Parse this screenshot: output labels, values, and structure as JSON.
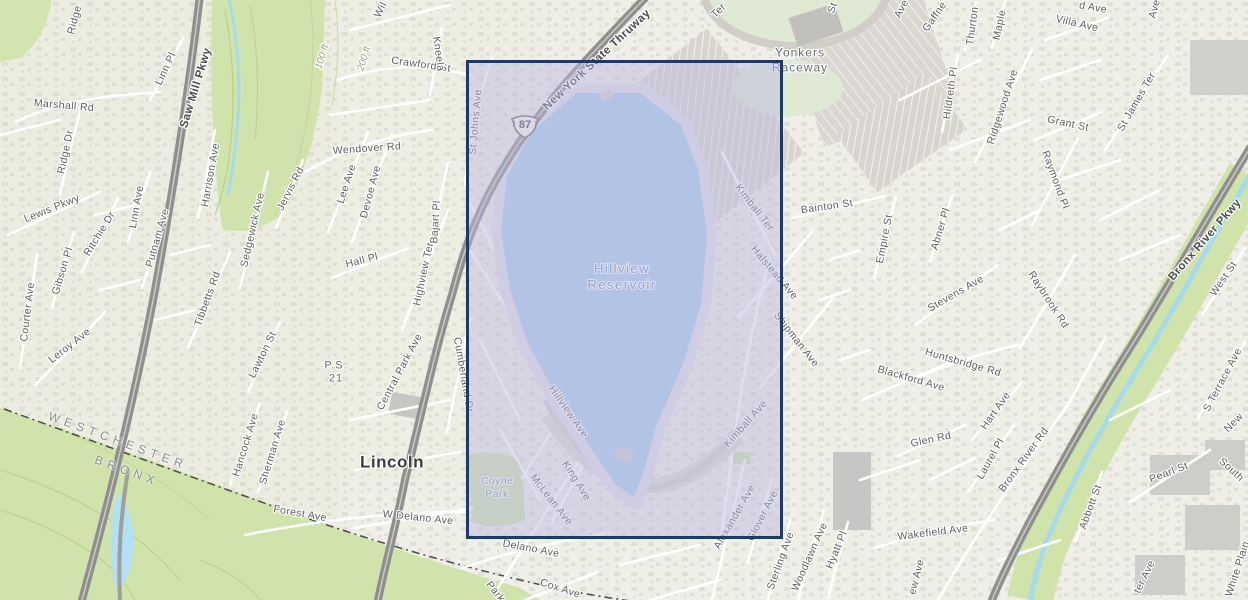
{
  "map": {
    "place_labels": {
      "reservoir": "Hillview\nReservoir",
      "raceway": "Yonkers\nRaceway",
      "city": "Lincoln",
      "park": "Coyne\nPark",
      "school": "P.S.\n21",
      "county_north": "WESTCHESTER",
      "county_south": "BRONX"
    },
    "shield": {
      "route": "87",
      "x": 525,
      "y": 126
    },
    "selection": {
      "x": 466,
      "y": 60,
      "width": 317,
      "height": 479
    },
    "colors": {
      "selection_border": "#1d3a66",
      "selection_fill": "rgba(188,185,226,0.48)",
      "water": "#a9cbe9",
      "park_green": "#cfe3ab",
      "major_road": "#949494",
      "land": "#efeee7"
    },
    "labels": [
      {
        "t": "Marshall Rd",
        "x": 64,
        "y": 106,
        "r": 5
      },
      {
        "t": "Linn Pl",
        "x": 166,
        "y": 69,
        "r": -65
      },
      {
        "t": "Ridge",
        "x": 75,
        "y": 20,
        "r": -75
      },
      {
        "t": "Ridge Dr",
        "x": 66,
        "y": 152,
        "r": -78
      },
      {
        "t": "Lewis Pkwy",
        "x": 52,
        "y": 209,
        "r": -22
      },
      {
        "t": "Gibson Pl",
        "x": 63,
        "y": 271,
        "r": -73
      },
      {
        "t": "Ritchie Dr",
        "x": 100,
        "y": 234,
        "r": -58
      },
      {
        "t": "Courter Ave",
        "x": 28,
        "y": 312,
        "r": -83
      },
      {
        "t": "Leroy Ave",
        "x": 70,
        "y": 346,
        "r": -38
      },
      {
        "t": "Linn Ave",
        "x": 137,
        "y": 207,
        "r": -80
      },
      {
        "t": "Putnam Ave",
        "x": 158,
        "y": 238,
        "r": -74
      },
      {
        "t": "Saw Mill Pkwy",
        "x": 196,
        "y": 88,
        "r": -73,
        "c": "major"
      },
      {
        "t": "Harrison Ave",
        "x": 211,
        "y": 175,
        "r": -80
      },
      {
        "t": "Sedgewick Ave",
        "x": 253,
        "y": 230,
        "r": -77
      },
      {
        "t": "Jervis Rd",
        "x": 291,
        "y": 189,
        "r": -63
      },
      {
        "t": "Tibbetts Rd",
        "x": 208,
        "y": 299,
        "r": -70
      },
      {
        "t": "Lawton St",
        "x": 263,
        "y": 355,
        "r": -64
      },
      {
        "t": "Hancock Ave",
        "x": 246,
        "y": 445,
        "r": -73
      },
      {
        "t": "Sherman Ave",
        "x": 273,
        "y": 452,
        "r": -73
      },
      {
        "t": "Forest Ave",
        "x": 300,
        "y": 514,
        "r": 10
      },
      {
        "t": "WESTCHESTER",
        "x": 118,
        "y": 441,
        "r": 20,
        "c": "boundary"
      },
      {
        "t": "BRONX",
        "x": 127,
        "y": 471,
        "r": 20,
        "c": "boundary"
      },
      {
        "t": "100 ft",
        "x": 323,
        "y": 57,
        "r": -73,
        "c": "contour"
      },
      {
        "t": "200 ft",
        "x": 365,
        "y": 59,
        "r": -73,
        "c": "contour"
      },
      {
        "t": "P.S.\n21",
        "x": 336,
        "y": 373,
        "r": 0,
        "c": "place",
        "fs": 11
      },
      {
        "t": "Lincoln",
        "x": 392,
        "y": 463,
        "r": 0,
        "c": "city"
      },
      {
        "t": "Central Park Ave",
        "x": 400,
        "y": 372,
        "r": -62
      },
      {
        "t": "Cumberland Dr",
        "x": 463,
        "y": 375,
        "r": 80
      },
      {
        "t": "W Delano Ave",
        "x": 418,
        "y": 518,
        "r": 6
      },
      {
        "t": "Delano Ave",
        "x": 531,
        "y": 549,
        "r": 11
      },
      {
        "t": "Cox Ave",
        "x": 560,
        "y": 589,
        "r": 18
      },
      {
        "t": "Park",
        "x": 495,
        "y": 592,
        "r": 52
      },
      {
        "t": "Coyne\nPark",
        "x": 497,
        "y": 488,
        "r": 0,
        "c": "park"
      },
      {
        "t": "McLean Ave",
        "x": 551,
        "y": 500,
        "r": 52
      },
      {
        "t": "King Ave",
        "x": 576,
        "y": 481,
        "r": 58
      },
      {
        "t": "Hillview Ave",
        "x": 568,
        "y": 412,
        "r": 55
      },
      {
        "t": "Hillview\nReservoir",
        "x": 622,
        "y": 277,
        "r": 0,
        "c": "water"
      },
      {
        "t": "St Johns Ave",
        "x": 476,
        "y": 122,
        "r": -85
      },
      {
        "t": "New York State Thruway",
        "x": 597,
        "y": 60,
        "r": -43,
        "c": "major"
      },
      {
        "t": "Crawford St",
        "x": 421,
        "y": 65,
        "r": 8
      },
      {
        "t": "Wendover Rd",
        "x": 367,
        "y": 149,
        "r": -4
      },
      {
        "t": "Lee Ave",
        "x": 347,
        "y": 184,
        "r": -72
      },
      {
        "t": "Devoe Ave",
        "x": 371,
        "y": 192,
        "r": -75
      },
      {
        "t": "Hall Pl",
        "x": 362,
        "y": 261,
        "r": -14
      },
      {
        "t": "Bajart Pl",
        "x": 436,
        "y": 222,
        "r": -86
      },
      {
        "t": "Highview Ter",
        "x": 424,
        "y": 274,
        "r": -78
      },
      {
        "t": "Kneela",
        "x": 438,
        "y": 54,
        "r": 82
      },
      {
        "t": "Wil",
        "x": 381,
        "y": 10,
        "r": -62
      },
      {
        "t": "Ter",
        "x": 719,
        "y": 11,
        "r": -45
      },
      {
        "t": "St",
        "x": 833,
        "y": 8,
        "r": -70
      },
      {
        "t": "Yonkers\nRaceway",
        "x": 800,
        "y": 60,
        "r": 0,
        "c": "place"
      },
      {
        "t": "Kimball Ter",
        "x": 754,
        "y": 208,
        "r": 52
      },
      {
        "t": "Halstead Ave",
        "x": 774,
        "y": 273,
        "r": 50
      },
      {
        "t": "Shipman Ave",
        "x": 796,
        "y": 340,
        "r": 52
      },
      {
        "t": "Kimball Ave",
        "x": 746,
        "y": 424,
        "r": -48
      },
      {
        "t": "Bainton St",
        "x": 827,
        "y": 207,
        "r": -8
      },
      {
        "t": "Gaffne",
        "x": 935,
        "y": 17,
        "r": -55
      },
      {
        "t": "Ave",
        "x": 902,
        "y": 9,
        "r": -62
      },
      {
        "t": "Thurton",
        "x": 973,
        "y": 26,
        "r": -82
      },
      {
        "t": "Maple",
        "x": 1000,
        "y": 25,
        "r": -78
      },
      {
        "t": "Hildreth Pl",
        "x": 951,
        "y": 93,
        "r": -82
      },
      {
        "t": "Ridgewood Ave",
        "x": 1003,
        "y": 107,
        "r": -72
      },
      {
        "t": "d Ave",
        "x": 1093,
        "y": 8,
        "r": 10
      },
      {
        "t": "Villa Ave",
        "x": 1077,
        "y": 24,
        "r": 13
      },
      {
        "t": "Grant St",
        "x": 1068,
        "y": 124,
        "r": 12
      },
      {
        "t": "Raymond Pl",
        "x": 1055,
        "y": 180,
        "r": 70
      },
      {
        "t": "St James Ter",
        "x": 1137,
        "y": 102,
        "r": -60
      },
      {
        "t": "Ave",
        "x": 1155,
        "y": 9,
        "r": -75
      },
      {
        "t": "Empire St",
        "x": 885,
        "y": 239,
        "r": -79
      },
      {
        "t": "Abner Pl",
        "x": 941,
        "y": 229,
        "r": -73
      },
      {
        "t": "Stevens Ave",
        "x": 956,
        "y": 294,
        "r": -30
      },
      {
        "t": "Raybrook Rd",
        "x": 1048,
        "y": 300,
        "r": 57
      },
      {
        "t": "Huntsbridge Rd",
        "x": 963,
        "y": 363,
        "r": 16
      },
      {
        "t": "Blackford Ave",
        "x": 911,
        "y": 379,
        "r": 16
      },
      {
        "t": "Glen Rd",
        "x": 931,
        "y": 440,
        "r": -12
      },
      {
        "t": "Hart Ave",
        "x": 996,
        "y": 411,
        "r": -55
      },
      {
        "t": "Laurel Pl",
        "x": 991,
        "y": 459,
        "r": -61
      },
      {
        "t": "Bronx River Rd",
        "x": 1024,
        "y": 460,
        "r": -54
      },
      {
        "t": "Wakefield Ave",
        "x": 933,
        "y": 533,
        "r": -7
      },
      {
        "t": "Abbott St",
        "x": 1091,
        "y": 507,
        "r": -70
      },
      {
        "t": "ew Ave",
        "x": 917,
        "y": 577,
        "r": -76
      },
      {
        "t": "Sterling Ave",
        "x": 781,
        "y": 561,
        "r": -70
      },
      {
        "t": "Woodlawn Ave",
        "x": 810,
        "y": 557,
        "r": -66
      },
      {
        "t": "Hyatt Pl",
        "x": 837,
        "y": 550,
        "r": -68
      },
      {
        "t": "Alexander Ave",
        "x": 735,
        "y": 517,
        "r": -60
      },
      {
        "t": "Glover Ave",
        "x": 763,
        "y": 516,
        "r": -63
      },
      {
        "t": "Bronx River Pkwy",
        "x": 1205,
        "y": 240,
        "r": -49,
        "c": "major"
      },
      {
        "t": "West St",
        "x": 1224,
        "y": 279,
        "r": -56
      },
      {
        "t": "S Terrace Ave",
        "x": 1223,
        "y": 380,
        "r": -62
      },
      {
        "t": "New",
        "x": 1234,
        "y": 423,
        "r": -45
      },
      {
        "t": "Pearl St",
        "x": 1169,
        "y": 473,
        "r": -21
      },
      {
        "t": "South",
        "x": 1231,
        "y": 470,
        "r": 42
      },
      {
        "t": "ter Ave",
        "x": 1145,
        "y": 577,
        "r": -64
      },
      {
        "t": "White Plain",
        "x": 1238,
        "y": 569,
        "r": -72
      }
    ]
  }
}
